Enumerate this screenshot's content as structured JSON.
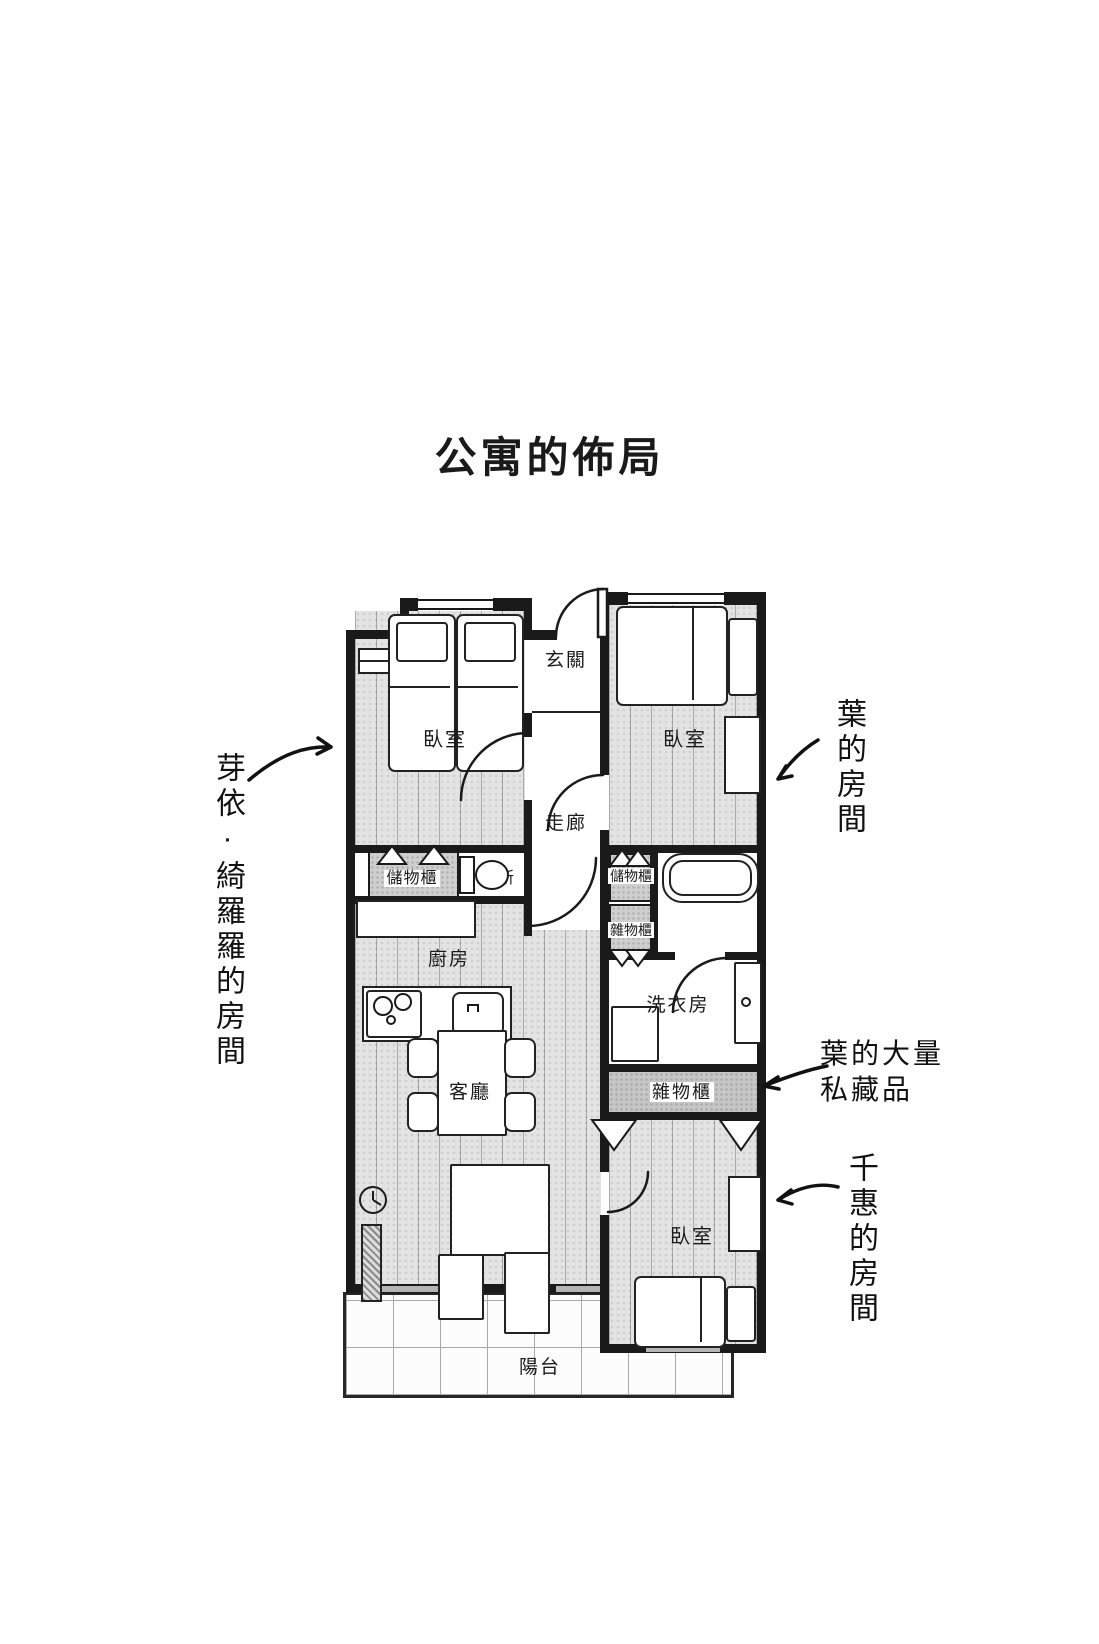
{
  "title": "公寓的佈局",
  "plan": {
    "rooms": {
      "bedroom_top_left": "臥室",
      "bedroom_top_right": "臥室",
      "bedroom_bottom_right": "臥室",
      "entrance": "玄關",
      "corridor": "走廊",
      "storage_left": "儲物櫃",
      "storage_right": "儲物櫃",
      "toilet": "廁所",
      "utility_small": "雜物櫃",
      "utility_large": "雜物櫃",
      "laundry": "洗衣房",
      "kitchen": "廚房",
      "living": "客廳",
      "balcony": "陽台"
    }
  },
  "annotations": {
    "left_room_owner": "芽依·綺羅羅的房間",
    "top_right_room_owner": "葉的房間",
    "collection_line1": "葉的大量",
    "collection_line2": "私藏品",
    "bottom_right_room_owner": "千惠的房間"
  },
  "colors": {
    "wall": "#1a1a1a",
    "floor_wood": "#e3e3e3",
    "cabinet_grey": "#cfcfcf",
    "band_grey": "#c6c6c6",
    "paper": "#ffffff"
  }
}
